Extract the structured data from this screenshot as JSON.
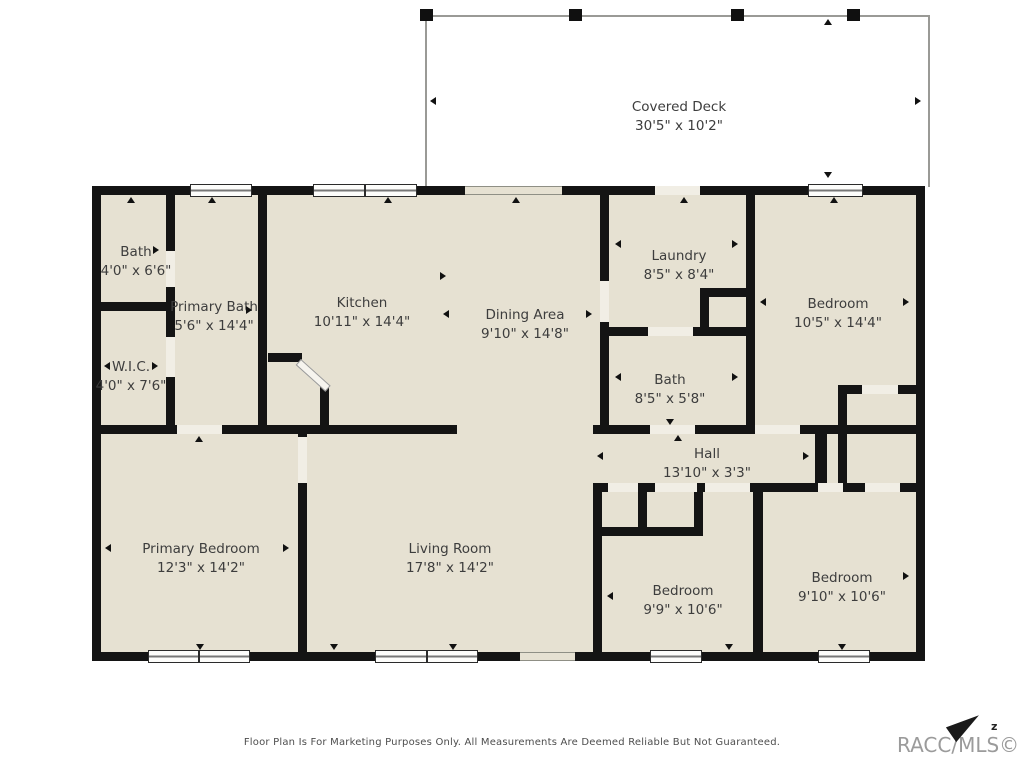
{
  "deck": {
    "name": "Covered Deck",
    "dims": "30'5\" x 10'2\""
  },
  "rooms": [
    {
      "name": "Bath",
      "dims": "4'0\" x 6'6\""
    },
    {
      "name": "Primary Bath",
      "dims": "5'6\" x 14'4\""
    },
    {
      "name": "W.I.C.",
      "dims": "4'0\" x 7'6\""
    },
    {
      "name": "Kitchen",
      "dims": "10'11\" x 14'4\""
    },
    {
      "name": "Dining Area",
      "dims": "9'10\" x 14'8\""
    },
    {
      "name": "Laundry",
      "dims": "8'5\" x 8'4\""
    },
    {
      "name": "Bath",
      "dims": "8'5\" x 5'8\""
    },
    {
      "name": "Bedroom",
      "dims": "10'5\" x 14'4\""
    },
    {
      "name": "Hall",
      "dims": "13'10\" x 3'3\""
    },
    {
      "name": "Primary Bedroom",
      "dims": "12'3\" x 14'2\""
    },
    {
      "name": "Living Room",
      "dims": "17'8\" x 14'2\""
    },
    {
      "name": "Bedroom",
      "dims": "9'9\" x 10'6\""
    },
    {
      "name": "Bedroom",
      "dims": "9'10\" x 10'6\""
    }
  ],
  "footer": "Floor Plan Is For Marketing Purposes Only. All Measurements Are Deemed Reliable But Not Guaranteed.",
  "watermark": "RACC/MLS©",
  "compass": "z",
  "colors": {
    "wall": "#141414",
    "wet": "#c9edf4",
    "bed": "#f0ca8e",
    "floor": "#e6e1d2",
    "closet": "#ece8dd",
    "deck": "#ffffff"
  }
}
